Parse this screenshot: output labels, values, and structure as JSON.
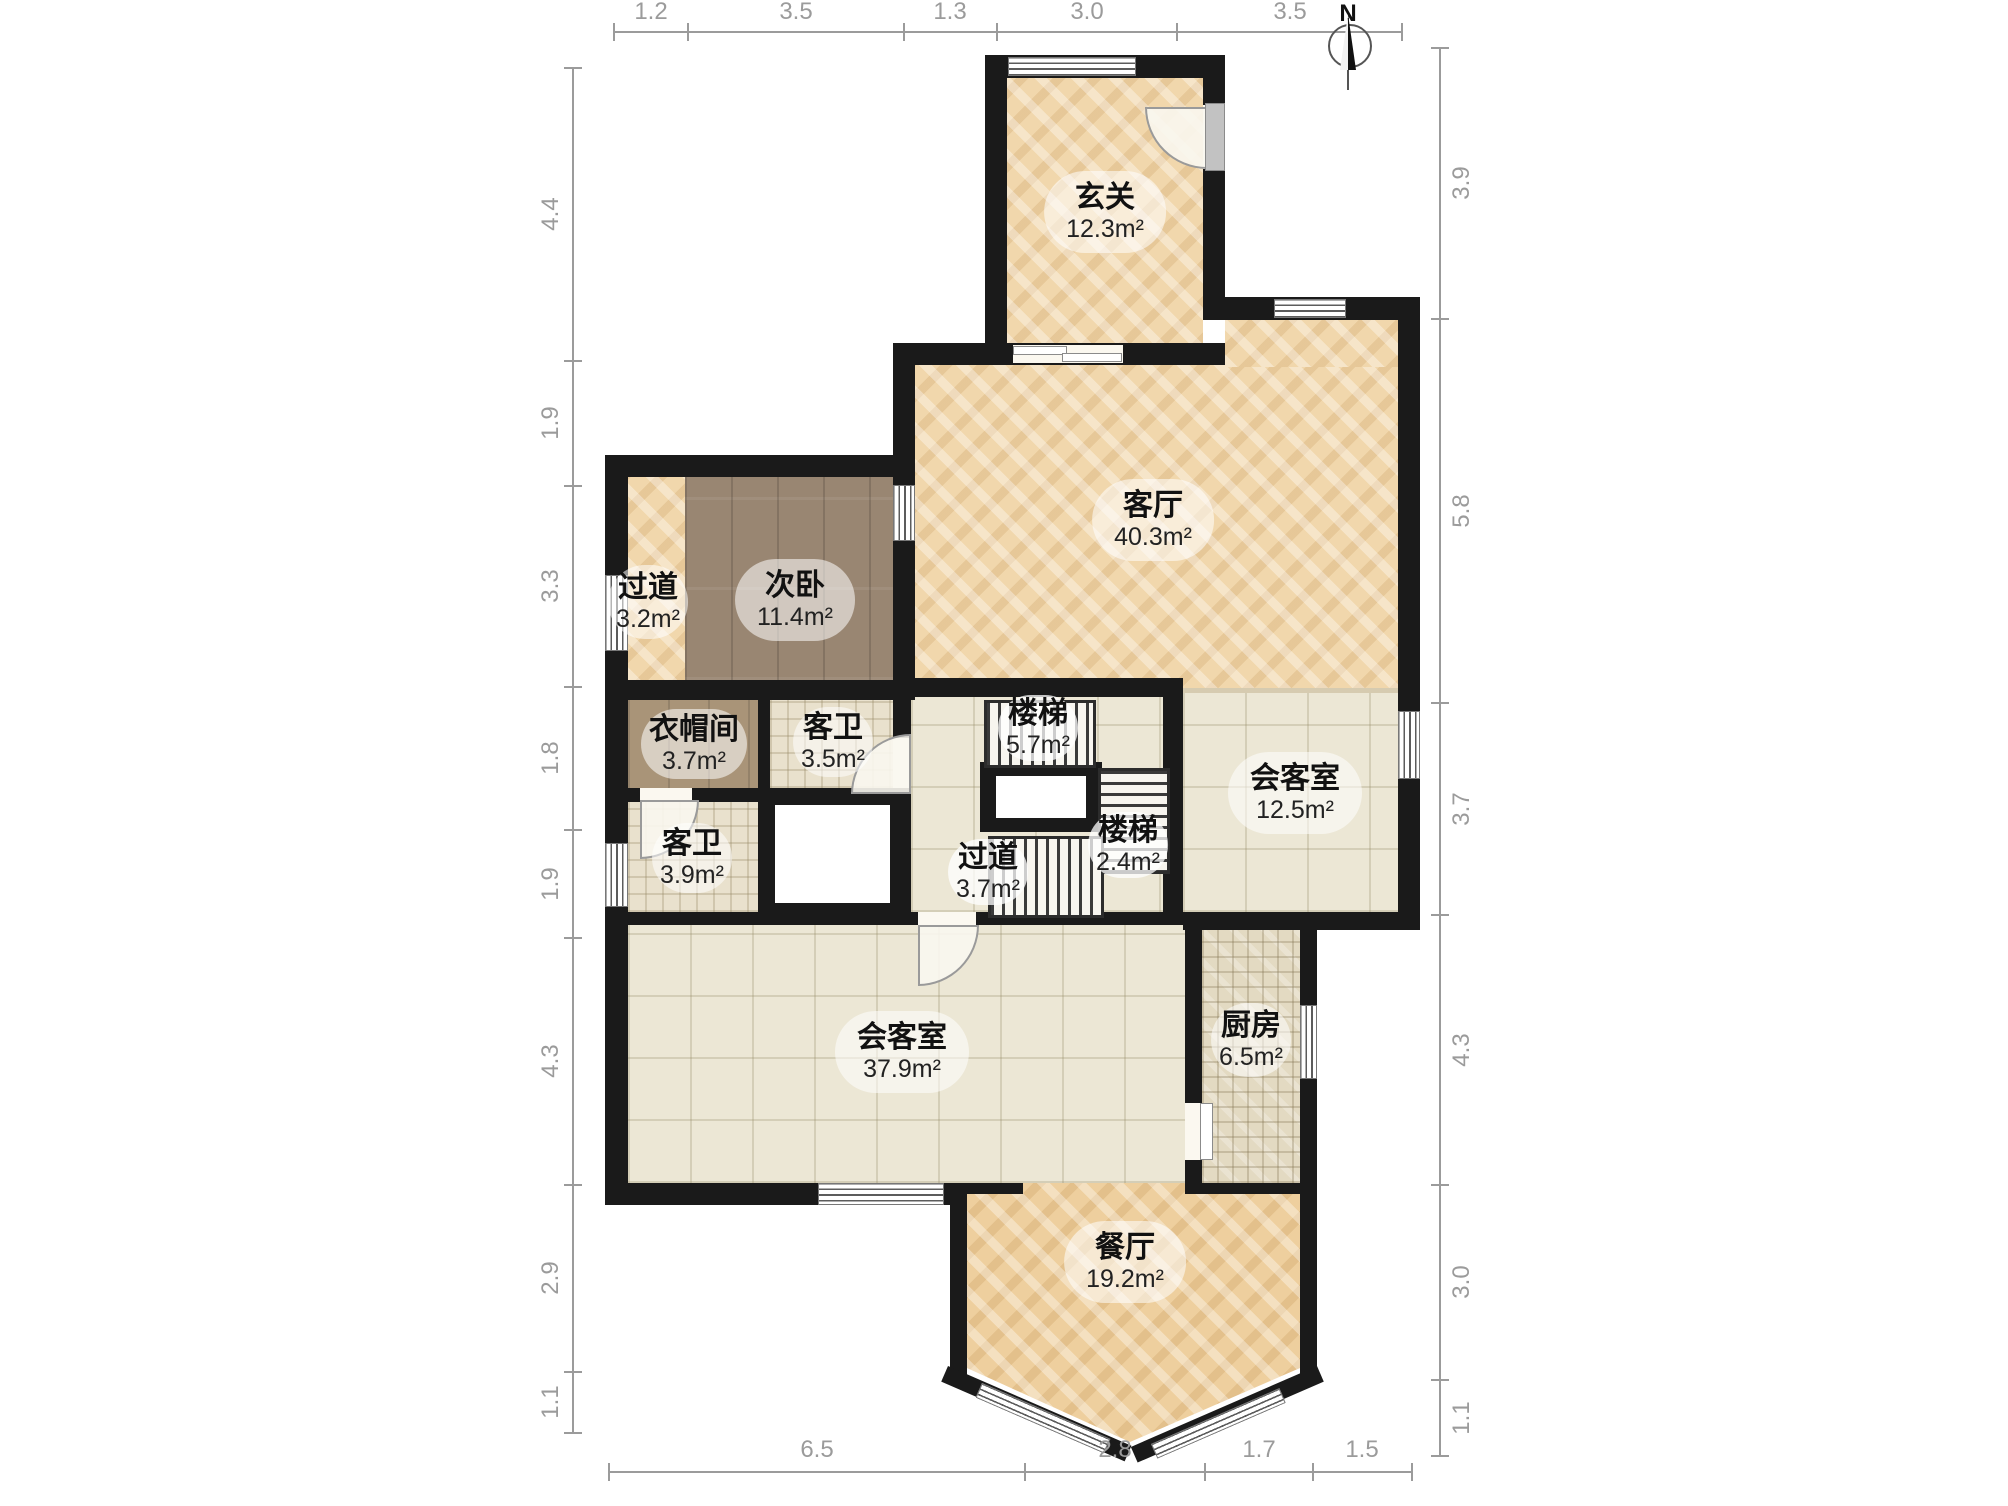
{
  "compass": {
    "label": "N"
  },
  "rooms": [
    {
      "name": "玄关",
      "area": "12.3m²"
    },
    {
      "name": "客厅",
      "area": "40.3m²"
    },
    {
      "name": "过道",
      "area": "3.2m²"
    },
    {
      "name": "次卧",
      "area": "11.4m²"
    },
    {
      "name": "衣帽间",
      "area": "3.7m²"
    },
    {
      "name": "客卫",
      "area": "3.5m²"
    },
    {
      "name": "楼梯",
      "area": "5.7m²"
    },
    {
      "name": "会客室",
      "area": "12.5m²"
    },
    {
      "name": "客卫",
      "area": "3.9m²"
    },
    {
      "name": "楼梯",
      "area": "2.4m²"
    },
    {
      "name": "过道",
      "area": "3.7m²"
    },
    {
      "name": "会客室",
      "area": "37.9m²"
    },
    {
      "name": "厨房",
      "area": "6.5m²"
    },
    {
      "name": "餐厅",
      "area": "19.2m²"
    }
  ],
  "dimensions": {
    "top": [
      "1.2",
      "3.5",
      "1.3",
      "3.0",
      "3.5"
    ],
    "right": [
      "3.9",
      "5.8",
      "3.7",
      "4.3",
      "3.0",
      "1.1"
    ],
    "bottom": [
      "6.5",
      "2.8",
      "1.7",
      "1.5"
    ],
    "left": [
      "4.4",
      "1.9",
      "3.3",
      "1.8",
      "1.9",
      "4.3",
      "2.9",
      "1.1"
    ]
  },
  "colors": {
    "wall": "#1a1a1a",
    "dim": "#9b9b9b",
    "parquet": "#f1d7ac",
    "parquet2": "#eecf9e",
    "wood-dark": "#998672",
    "wood-mid": "#a99478",
    "tile-big": "#ece7d5",
    "tile-small": "#e9e1cd",
    "mosaic": "#e3dac2"
  }
}
